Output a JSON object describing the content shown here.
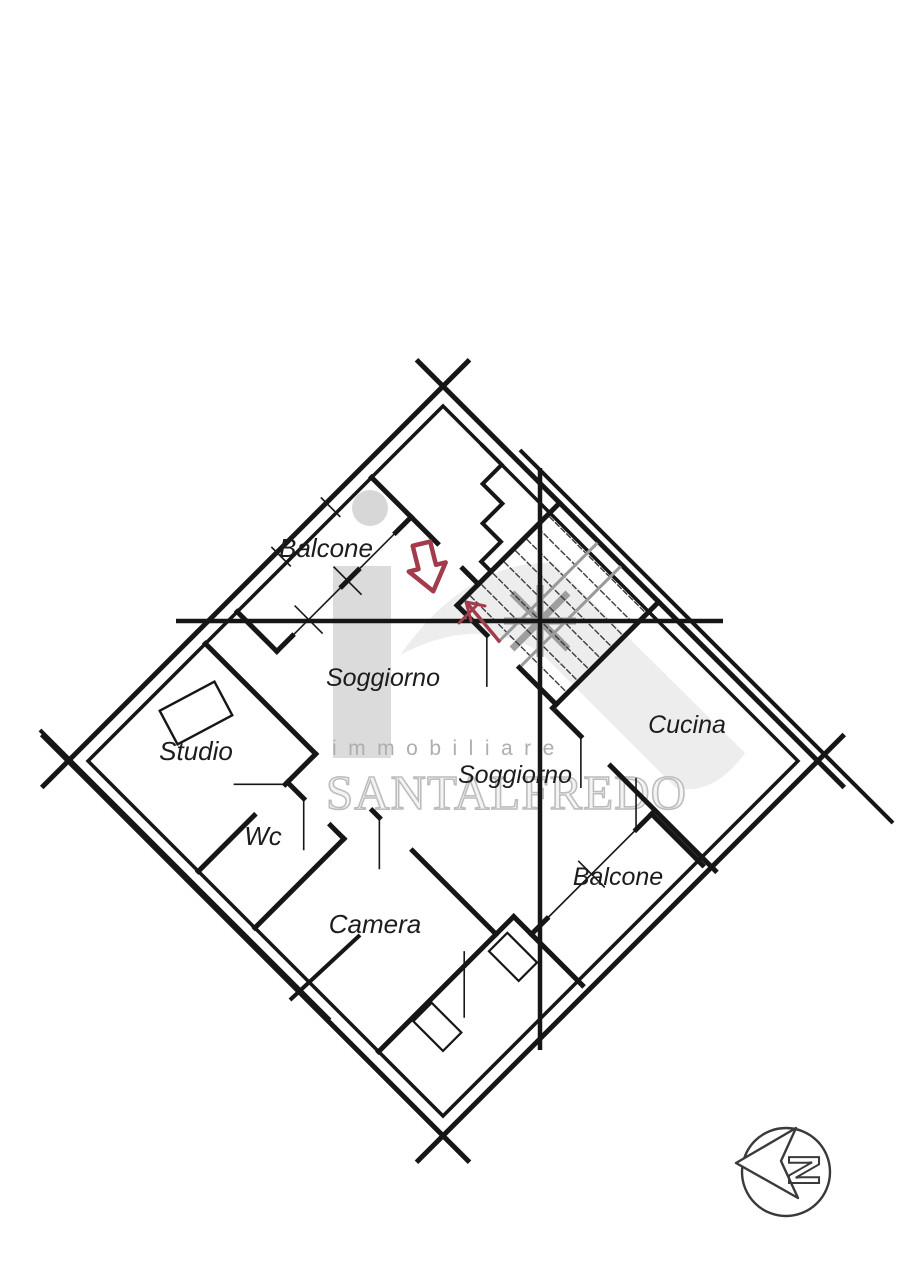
{
  "plan": {
    "rooms": [
      {
        "id": "balcone-1",
        "label": "Balcone"
      },
      {
        "id": "soggiorno-1",
        "label": "Soggiorno"
      },
      {
        "id": "studio",
        "label": "Studio"
      },
      {
        "id": "wc",
        "label": "Wc"
      },
      {
        "id": "camera",
        "label": "Camera"
      },
      {
        "id": "soggiorno-2",
        "label": "Soggiorno"
      },
      {
        "id": "cucina",
        "label": "Cucina"
      },
      {
        "id": "balcone-2",
        "label": "Balcone"
      }
    ]
  },
  "watermark": {
    "line1": "immobiliare",
    "line2": "SANTALFREDO"
  },
  "compass": {
    "letter": "N"
  },
  "colors": {
    "wall": "#161616",
    "accent_arrow": "#a23b4b",
    "watermark_gray": "#bdbdbd",
    "stair_gray": "#9a9a9a"
  }
}
